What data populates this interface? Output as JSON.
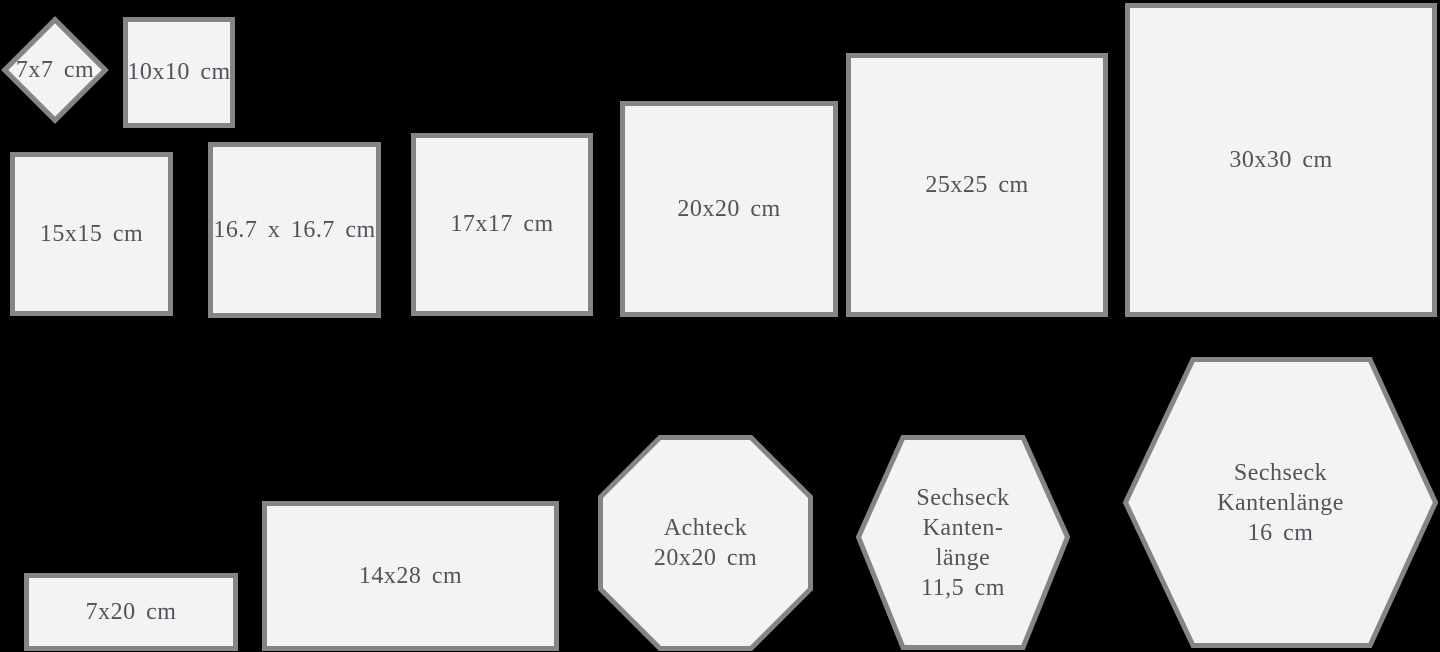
{
  "colors": {
    "background": "#000000",
    "tile_fill": "#f3f3f3",
    "tile_border": "#858585",
    "label_text": "#4f545b"
  },
  "tiles": {
    "diamond_7x7": {
      "label": "7x7 cm"
    },
    "square_10x10": {
      "label": "10x10 cm"
    },
    "square_15x15": {
      "label": "15x15 cm"
    },
    "square_16_7": {
      "label": "16.7 x 16.7 cm"
    },
    "square_17x17": {
      "label": "17x17 cm"
    },
    "square_20x20": {
      "label": "20x20 cm"
    },
    "square_25x25": {
      "label": "25x25 cm"
    },
    "square_30x30": {
      "label": "30x30 cm"
    },
    "rect_7x20": {
      "label": "7x20 cm"
    },
    "rect_14x28": {
      "label": "14x28 cm"
    },
    "octagon_20x20": {
      "lines": [
        "Achteck",
        "20x20 cm"
      ]
    },
    "hexagon_11_5": {
      "lines": [
        "Sechseck",
        "Kanten-",
        "länge",
        "11,5 cm"
      ]
    },
    "hexagon_16": {
      "lines": [
        "Sechseck",
        "Kantenlänge",
        "16 cm"
      ]
    }
  }
}
